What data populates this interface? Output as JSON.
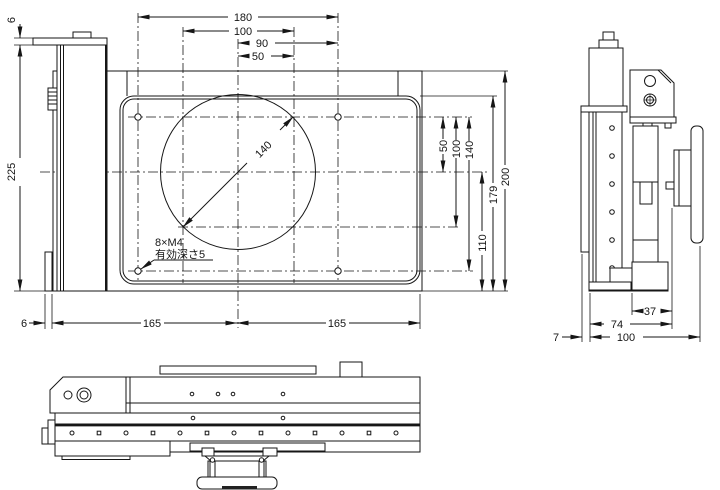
{
  "drawing": {
    "kind": "engineering-dimension-drawing",
    "line_color": "#161616",
    "background": "#ffffff",
    "top_view": {
      "dims_top": {
        "outer_width": "180",
        "inner_width": "100",
        "half_right": "90",
        "half_inner": "50"
      },
      "dims_left": {
        "bar_height": "6",
        "total_depth": "225"
      },
      "dims_right": {
        "v50": "50",
        "v100": "100",
        "v140": "140",
        "v110": "110",
        "v179": "179",
        "v200": "200"
      },
      "dims_bottom": {
        "edge_gap": "6",
        "left_span": "165",
        "right_span": "165"
      },
      "circle_diameter": "140",
      "thread_note_line1": "8×M4",
      "thread_note_line2": "有効深さ5"
    },
    "side_view": {
      "dims_bottom": {
        "block_width": "37",
        "body_width": "74",
        "total_width": "100",
        "plate_thickness": "7"
      }
    }
  }
}
